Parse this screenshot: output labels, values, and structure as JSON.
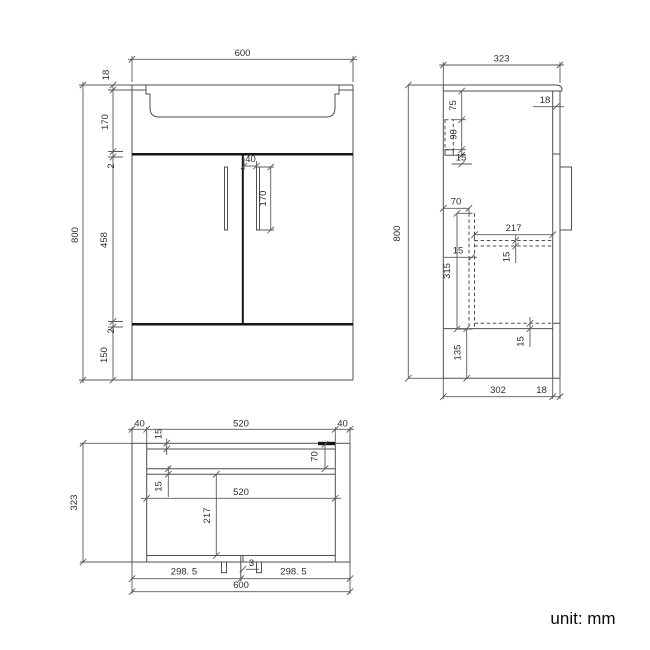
{
  "note": {
    "unit_label": "unit: mm"
  },
  "style": {
    "line_color": "#4f4f4f",
    "text_color": "#2e2e2e",
    "background": "#ffffff"
  },
  "front_view": {
    "overall_width": "600",
    "overall_height": "800",
    "worktop_height": "18",
    "basin_depth": "170",
    "gap_top": "2",
    "door_height": "458",
    "gap_bottom": "2",
    "plinth_height": "150",
    "handle_offset": "40",
    "handle_length": "170"
  },
  "side_view": {
    "overall_depth": "323",
    "overall_height": "800",
    "worktop_thickness": "18",
    "bracket_offset": "75",
    "bracket_height": "90",
    "bracket_base": "15",
    "back_rail_depth": "70",
    "shelf_depth": "217",
    "divider_thickness": "15",
    "shelf_thickness": "15",
    "divider_height": "315",
    "bottom_clearance": "135",
    "bottom_panel_thickness": "15",
    "internal_depth": "302",
    "door_thickness": "18"
  },
  "plan_view": {
    "side_panel_left": "40",
    "back_panel_thickness": "15",
    "top_inner_width": "520",
    "side_panel_right": "40",
    "back_rail_depth": "70",
    "rail_thickness": "15",
    "inner_width": "520",
    "inner_depth": "217",
    "left_door_width": "298. 5",
    "door_gap": "3",
    "right_door_width": "298. 5",
    "overall_width": "600",
    "overall_depth": "323"
  }
}
